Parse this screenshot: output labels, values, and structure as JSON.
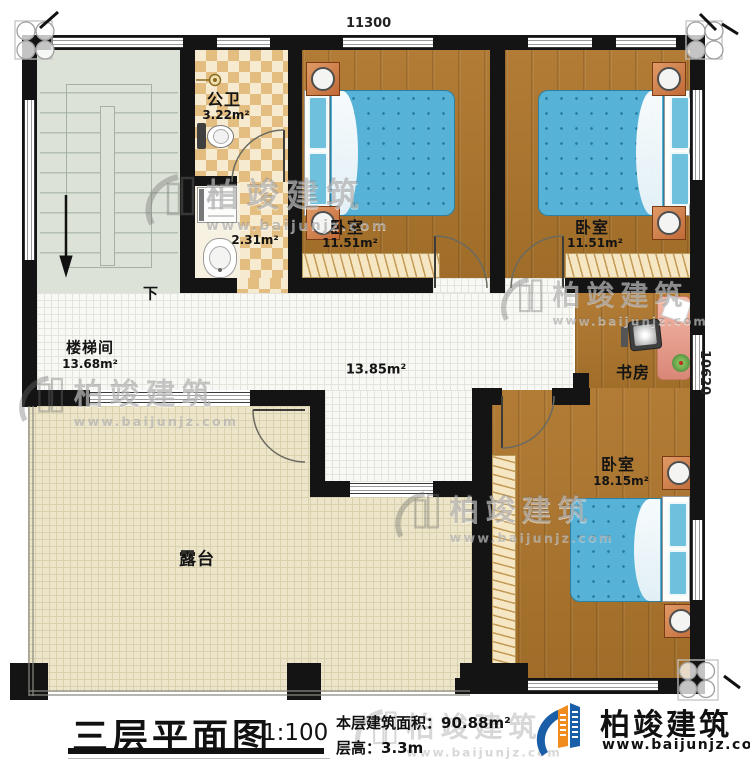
{
  "dimensions": {
    "top": "11300",
    "right": "10620"
  },
  "rooms": {
    "stairwell": {
      "name": "楼梯间",
      "area": "13.68m²",
      "down_label": "下"
    },
    "bathroom": {
      "name": "公卫",
      "area": "3.22m²",
      "area2": "2.31m²"
    },
    "bedroom1": {
      "name": "卧室",
      "area": "11.51m²"
    },
    "bedroom2": {
      "name": "卧室",
      "area": "11.51m²"
    },
    "hall": {
      "area": "13.85m²"
    },
    "study": {
      "name": "书房"
    },
    "bedroom3": {
      "name": "卧室",
      "area": "18.15m²"
    },
    "terrace": {
      "name": "露台"
    }
  },
  "titleblock": {
    "title": "三层平面图",
    "scale": "1:100",
    "area_label": "本层建筑面积：",
    "area_value": "90.88m²",
    "height_label": "层高：",
    "height_value": "3.3m"
  },
  "logo": {
    "name": "柏竣建筑",
    "url": "www.baijunjz.com"
  },
  "watermark": {
    "brand": "柏竣建筑",
    "url": "www.baijunjz.com"
  },
  "colors": {
    "wall": "#141414",
    "wood": "#a97733",
    "bed": "#56b2d6",
    "terrace": "#ece5c9",
    "accent_orange": "#f08c1e",
    "accent_blue": "#1b5ea8"
  }
}
